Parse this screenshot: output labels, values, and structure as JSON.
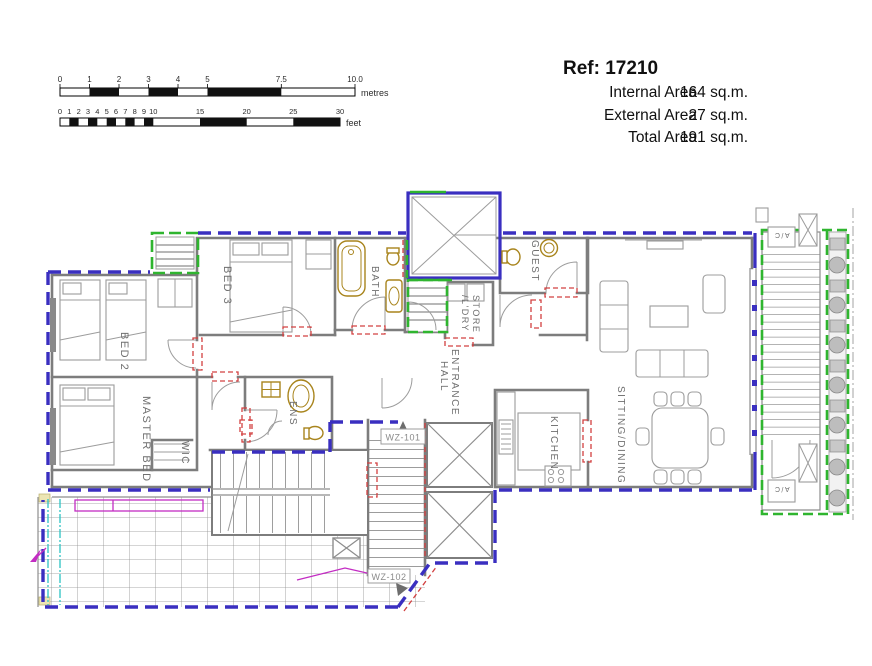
{
  "header": {
    "ref": "Ref: 17210",
    "areas": [
      {
        "label": "Internal Area",
        "value": "164 sq.m."
      },
      {
        "label": "External Area",
        "value": "27 sq.m."
      },
      {
        "label": "Total Area",
        "value": "191 sq.m."
      }
    ]
  },
  "scalebar": {
    "metres": {
      "unit": "metres",
      "ticks": [
        "0",
        "1",
        "2",
        "3",
        "4",
        "5",
        "7.5",
        "10.0"
      ]
    },
    "feet": {
      "unit": "feet",
      "ticks": [
        "0",
        "1",
        "2",
        "3",
        "4",
        "5",
        "6",
        "7",
        "8",
        "9",
        "10",
        "15",
        "20",
        "25",
        "30"
      ]
    }
  },
  "rooms": {
    "bed2": "BED 2",
    "bed3": "BED 3",
    "master": "MASTER BED",
    "wic": "WIC",
    "ens": "ENS",
    "bath": "BATH",
    "guest": "GUEST",
    "store_line1": "STORE",
    "store_line2": "/L'DRY",
    "hall_line1": "ENTRANCE",
    "hall_line2": "HALL",
    "kitchen": "KITCHEN",
    "sitting": "SITTING/DINING"
  },
  "annotations": {
    "wz101": "WZ-101",
    "wz102": "WZ-102",
    "ac": "A/C"
  },
  "colors": {
    "internal": "#3a2fc0",
    "external": "#2fb52f",
    "opening": "#d24040",
    "magenta": "#c32cc3",
    "cyan": "#2cc3c3",
    "fixture": "#a8841c"
  }
}
